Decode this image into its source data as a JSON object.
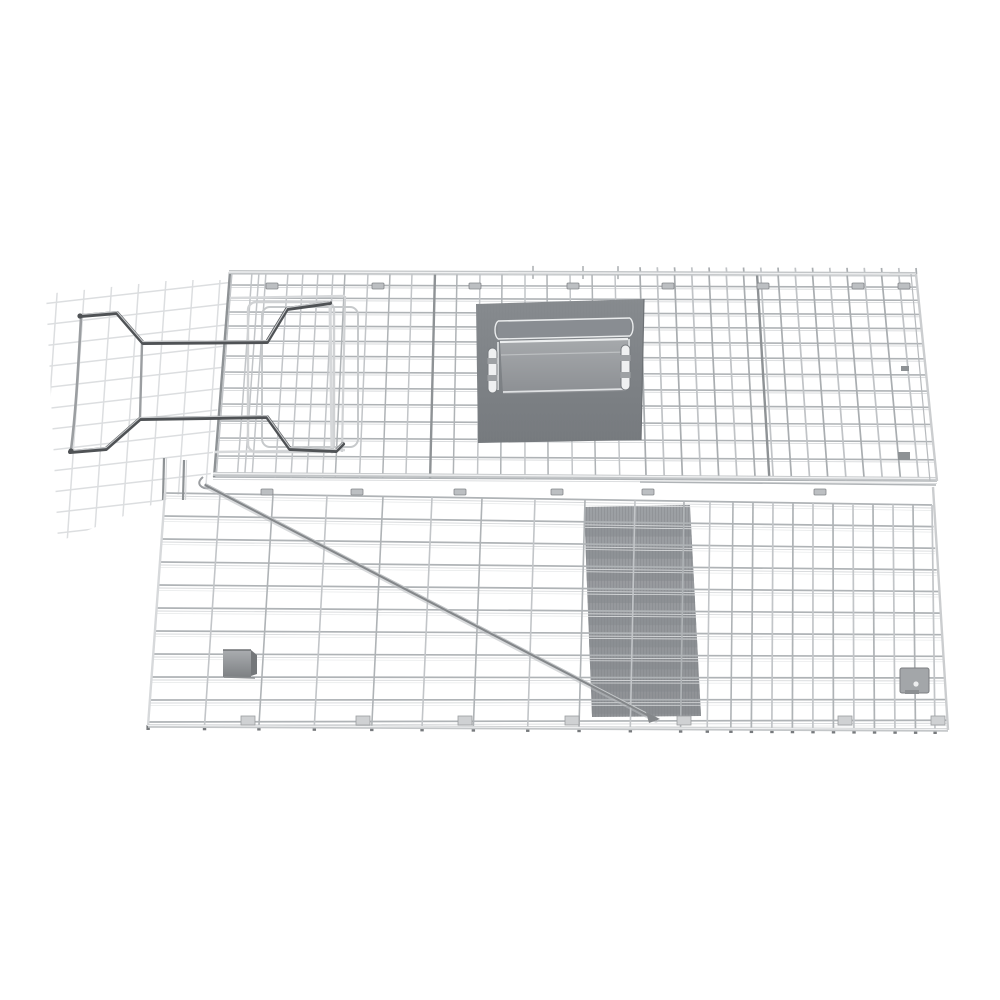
{
  "image": {
    "subject": "flat-packed collapsible wire mesh live animal trap cage, top-down studio product photo on white background"
  },
  "palette": {
    "background": "#ffffff",
    "wire": "#afb3b6",
    "wire_alt": "#c2c5c8",
    "wire_light": "#d7d9db",
    "wire_lighter": "#e6e8e9",
    "wire_dark": "#8e9295",
    "wire_faint": "#d9dbdd",
    "rail": "#c3c6c8",
    "rail_core": "#f0f1f2",
    "plate": "#7f8387",
    "plate_edge": "#6d7175",
    "strip_top": "#a6a9ac",
    "strip_bottom": "#8c8f93",
    "bright": "#e9ebec",
    "slot_fill": "#eff0f1",
    "slot_border": "#75797d",
    "trip_top": "#9da0a4",
    "trip_bottom": "#8e9195",
    "trip_band": "#84878b",
    "lock_dark": "#4f5255",
    "lock_mid": "#9b9ea1",
    "lock_light": "#d6d8da",
    "rod": "#84878a",
    "rod_hi": "#cdd0d2",
    "clip": "#bcbfc2",
    "clip_border": "#84878a",
    "box_light": "#aaadb0",
    "box_dark": "#74777a",
    "foot": "#cfd1d3",
    "dot": "#777a7d"
  },
  "scene": {
    "canvas": {
      "w": 1000,
      "h": 1000
    },
    "faint_panel": {
      "clip": [
        [
          46,
          294
        ],
        [
          231,
          274
        ],
        [
          210,
          482
        ],
        [
          58,
          542
        ]
      ],
      "v_count": 7,
      "v_x0": 52,
      "v_dx": 27,
      "v_top_lean": 6,
      "v_bot_lean": -12,
      "v_y1": 280,
      "v_y2": 544,
      "h_count": 12,
      "h_y0": 294,
      "h_dy": 21,
      "h_x1": 42,
      "h_x2": 234,
      "h_rise": -22
    },
    "upper_panel": {
      "y_top_left": 272,
      "y_top_right": 274,
      "y_bottom_left": 477,
      "y_bottom_right": 481,
      "left_top_x": 229,
      "left_bottom_x": 213,
      "right_top_x": 916,
      "right_bottom_x": 937,
      "h_ys": [
        272,
        285,
        298,
        312,
        326,
        341,
        356,
        372,
        388,
        404,
        421,
        438,
        456,
        477
      ],
      "verts_a": [
        232,
        252,
        259,
        266,
        288,
        303,
        318,
        333
      ],
      "verts_b": [
        345,
        368,
        390,
        412,
        457,
        480,
        502,
        525,
        547,
        570,
        592,
        615
      ],
      "verts_c_start": 640,
      "verts_c_step": 17.25,
      "verts_c_count": 17,
      "dark_verts": [
        230,
        435,
        757
      ],
      "extra_stubs": [
        533,
        583,
        618
      ],
      "door_rails": [
        [
          230,
          298,
          345,
          296
        ],
        [
          215,
          452,
          345,
          450
        ]
      ],
      "door_post": [
        345,
        296,
        342,
        452
      ],
      "clips_y": 283,
      "clips_x": [
        272,
        378,
        475,
        573,
        668,
        763,
        858,
        904
      ]
    },
    "lower_panel": {
      "y_top_left": 493,
      "y_top_right": 505,
      "y_bottom_left": 726,
      "y_bottom_right": 730,
      "left_top_x": 165,
      "left_bottom_x": 148,
      "right_top_x": 932,
      "right_bottom_x": 948,
      "h_ys": [
        493,
        516,
        539,
        562,
        585,
        608,
        631,
        654,
        677,
        700,
        722
      ],
      "verts_left": [
        165,
        220,
        273,
        327,
        383,
        432,
        482,
        535,
        585,
        635,
        684,
        710,
        733
      ],
      "verts_right": [
        753,
        773,
        793,
        813,
        833,
        853,
        873,
        893,
        913,
        932
      ],
      "corner_posts": [
        [
          164,
          458,
          500
        ],
        [
          184,
          460,
          500
        ]
      ],
      "seam_clips_y": 489,
      "seam_clips_x": [
        267,
        357,
        460,
        557,
        648,
        820
      ],
      "feet_y": 716,
      "feet_x": [
        248,
        363,
        465,
        572,
        684,
        845,
        938
      ]
    },
    "trip_plate": {
      "poly": [
        [
          584,
          507
        ],
        [
          690,
          505
        ],
        [
          701,
          716
        ],
        [
          592,
          717
        ]
      ]
    },
    "trigger_rod": {
      "x1": 206,
      "y1": 485,
      "x2": 656,
      "y2": 719
    },
    "lock": {
      "top_lever": "M80,316 L117,313 L143,343 L267,342 L287,309 L330,303",
      "bottom_lever": "M70,452 L106,449 L140,419 L267,417 L290,449 L336,451 L343,444",
      "left_side": "M81,318 C78,370 76,410 71,450",
      "right_side": "M330,303 L332,452",
      "connector": "M142,344 L140,418",
      "frame1": [
        248,
        302,
        86,
        150
      ],
      "frame2": [
        262,
        307,
        96,
        140
      ],
      "caps": [
        [
          80,
          316
        ],
        [
          71,
          451
        ]
      ],
      "hook": "M203,477 q-7,6 -1,10 q5,3 9,-1"
    },
    "handle_plate": {
      "poly": [
        [
          476,
          304
        ],
        [
          644,
          299
        ],
        [
          641,
          440
        ],
        [
          478,
          443
        ]
      ],
      "bar_top": [
        498,
        321,
        630,
        318
      ],
      "bar_bottom": [
        498,
        339,
        630,
        336
      ],
      "strip": [
        [
          500,
          342
        ],
        [
          628,
          339
        ],
        [
          626,
          391
        ],
        [
          503,
          394
        ]
      ],
      "slots": [
        [
          488,
          348
        ],
        [
          621,
          345
        ]
      ],
      "slot_w": 9,
      "slot_h": 45
    },
    "parts": {
      "latch_box": [
        223,
        650,
        28,
        27
      ],
      "hole_plate": [
        900,
        668,
        29,
        25
      ],
      "hole": [
        916,
        684
      ],
      "right_ticks": [
        [
          901,
          366,
          8,
          5
        ],
        [
          898,
          452,
          12,
          8
        ]
      ]
    }
  }
}
